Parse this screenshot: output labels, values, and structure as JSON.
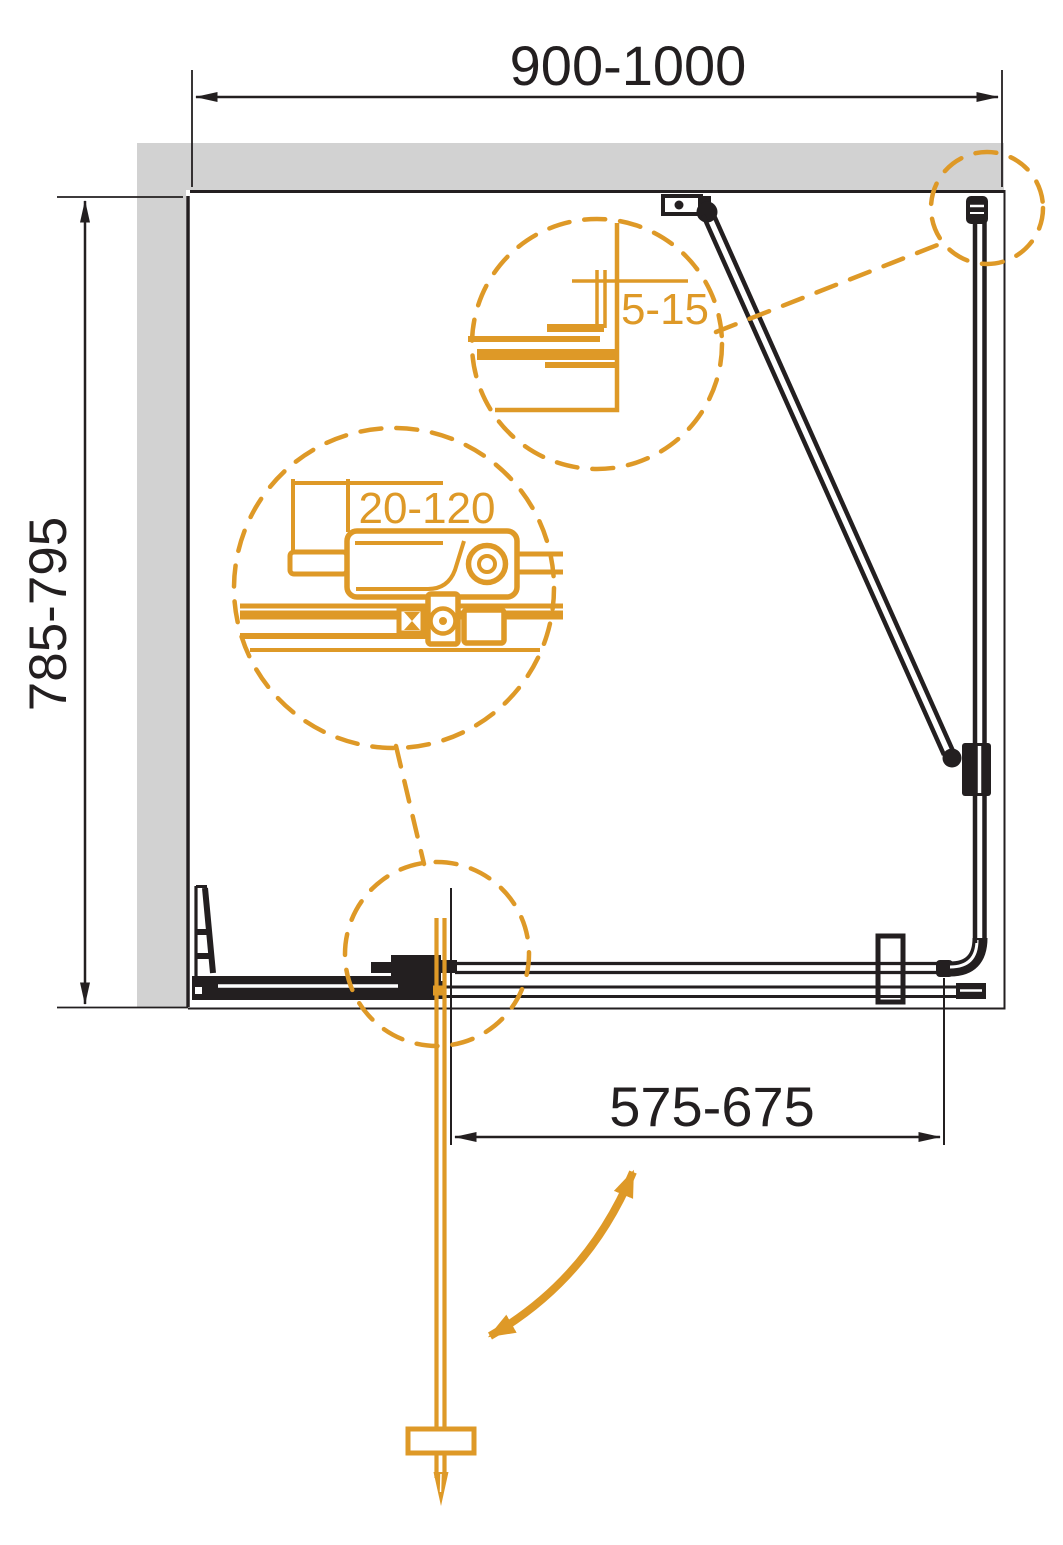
{
  "plan": {
    "title": "shower-enclosure-plan-drawing",
    "dimensions": {
      "width_top": "900-1000",
      "height_left": "785-795",
      "door_clearance_bottom": "575-675"
    },
    "callouts": {
      "wall_profile_gap": "5-15",
      "roller_adjustment_range": "20-120"
    },
    "colors": {
      "accent_orange": "#de9927",
      "line_black": "#231f20",
      "wall_gray": "#d2d2d2",
      "background": "#ffffff"
    }
  }
}
